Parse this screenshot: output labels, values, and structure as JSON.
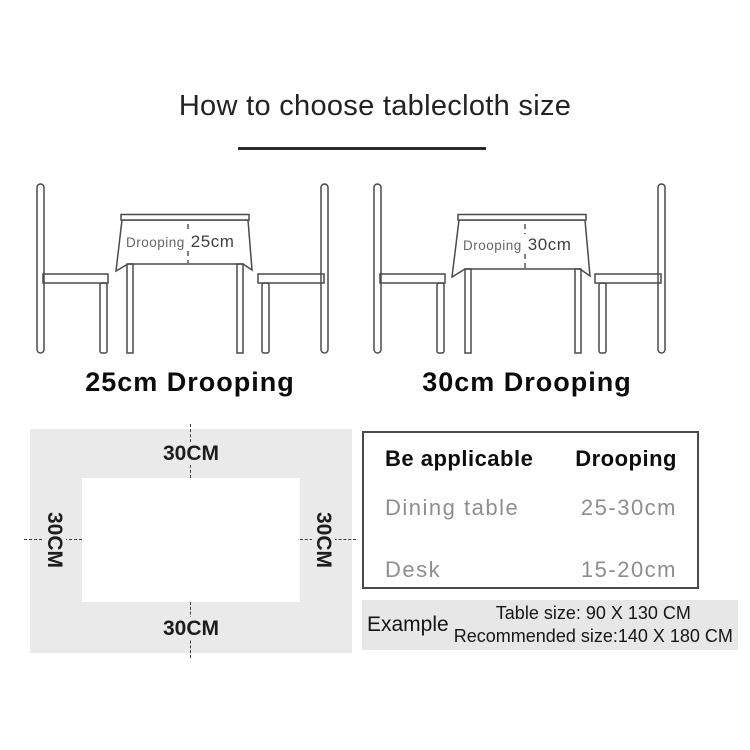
{
  "title": "How to choose tablecloth size",
  "diagrams": {
    "left": {
      "drooping_word": "Drooping",
      "drooping_value": "25cm",
      "caption": "25cm Drooping"
    },
    "right": {
      "drooping_word": "Drooping",
      "drooping_value": "30cm",
      "caption": "30cm Drooping"
    }
  },
  "measurement_diagram": {
    "top_label": "30CM",
    "bottom_label": "30CM",
    "left_label": "30CM",
    "right_label": "30CM"
  },
  "spec_table": {
    "headers": [
      "Be applicable",
      "Drooping"
    ],
    "rows": [
      {
        "item": "Dining table",
        "drooping": "25-30cm"
      },
      {
        "item": "Desk",
        "drooping": "15-20cm"
      }
    ]
  },
  "example": {
    "label": "Example",
    "table_size": "Table size:  90 X 130 CM",
    "recommended_size": "Recommended size:140 X 180 CM"
  },
  "colors": {
    "line": "#4a4a4a",
    "panel_gray": "#eaeaea",
    "muted_text": "#8e8e8e"
  }
}
